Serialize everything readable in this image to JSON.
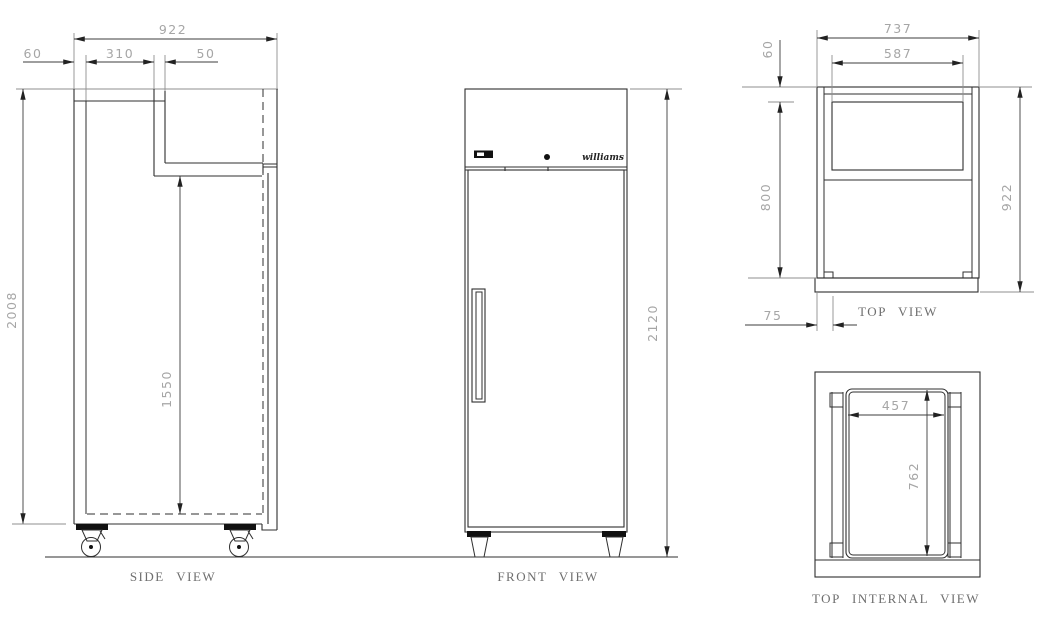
{
  "views": {
    "side": {
      "label": "SIDE VIEW",
      "dim_depth_overall": "922",
      "dim_rear_gap": "60",
      "dim_recess_offset": "310",
      "dim_recess_step": "50",
      "dim_height_cabinet": "2008",
      "dim_height_internal": "1550"
    },
    "front": {
      "label": "FRONT VIEW",
      "brand_logo": "williams",
      "dim_height_overall": "2120"
    },
    "top": {
      "label": "TOP VIEW",
      "dim_width_overall": "737",
      "dim_recess_width": "587",
      "dim_top_gap": "60",
      "dim_depth_body": "800",
      "dim_depth_overall": "922",
      "dim_door_offset": "75"
    },
    "top_internal": {
      "label": "TOP INTERNAL VIEW",
      "dim_liner_width": "457",
      "dim_liner_depth": "762"
    }
  },
  "colors": {
    "drawing_line": "#2f2f2f",
    "extension_line": "#8f8f8f",
    "dimension_line": "#3c3c3c",
    "dimension_text": "#a6a6a6",
    "view_label_text": "#6e6e6e",
    "panel_fill": "#111111",
    "background": "#ffffff"
  }
}
